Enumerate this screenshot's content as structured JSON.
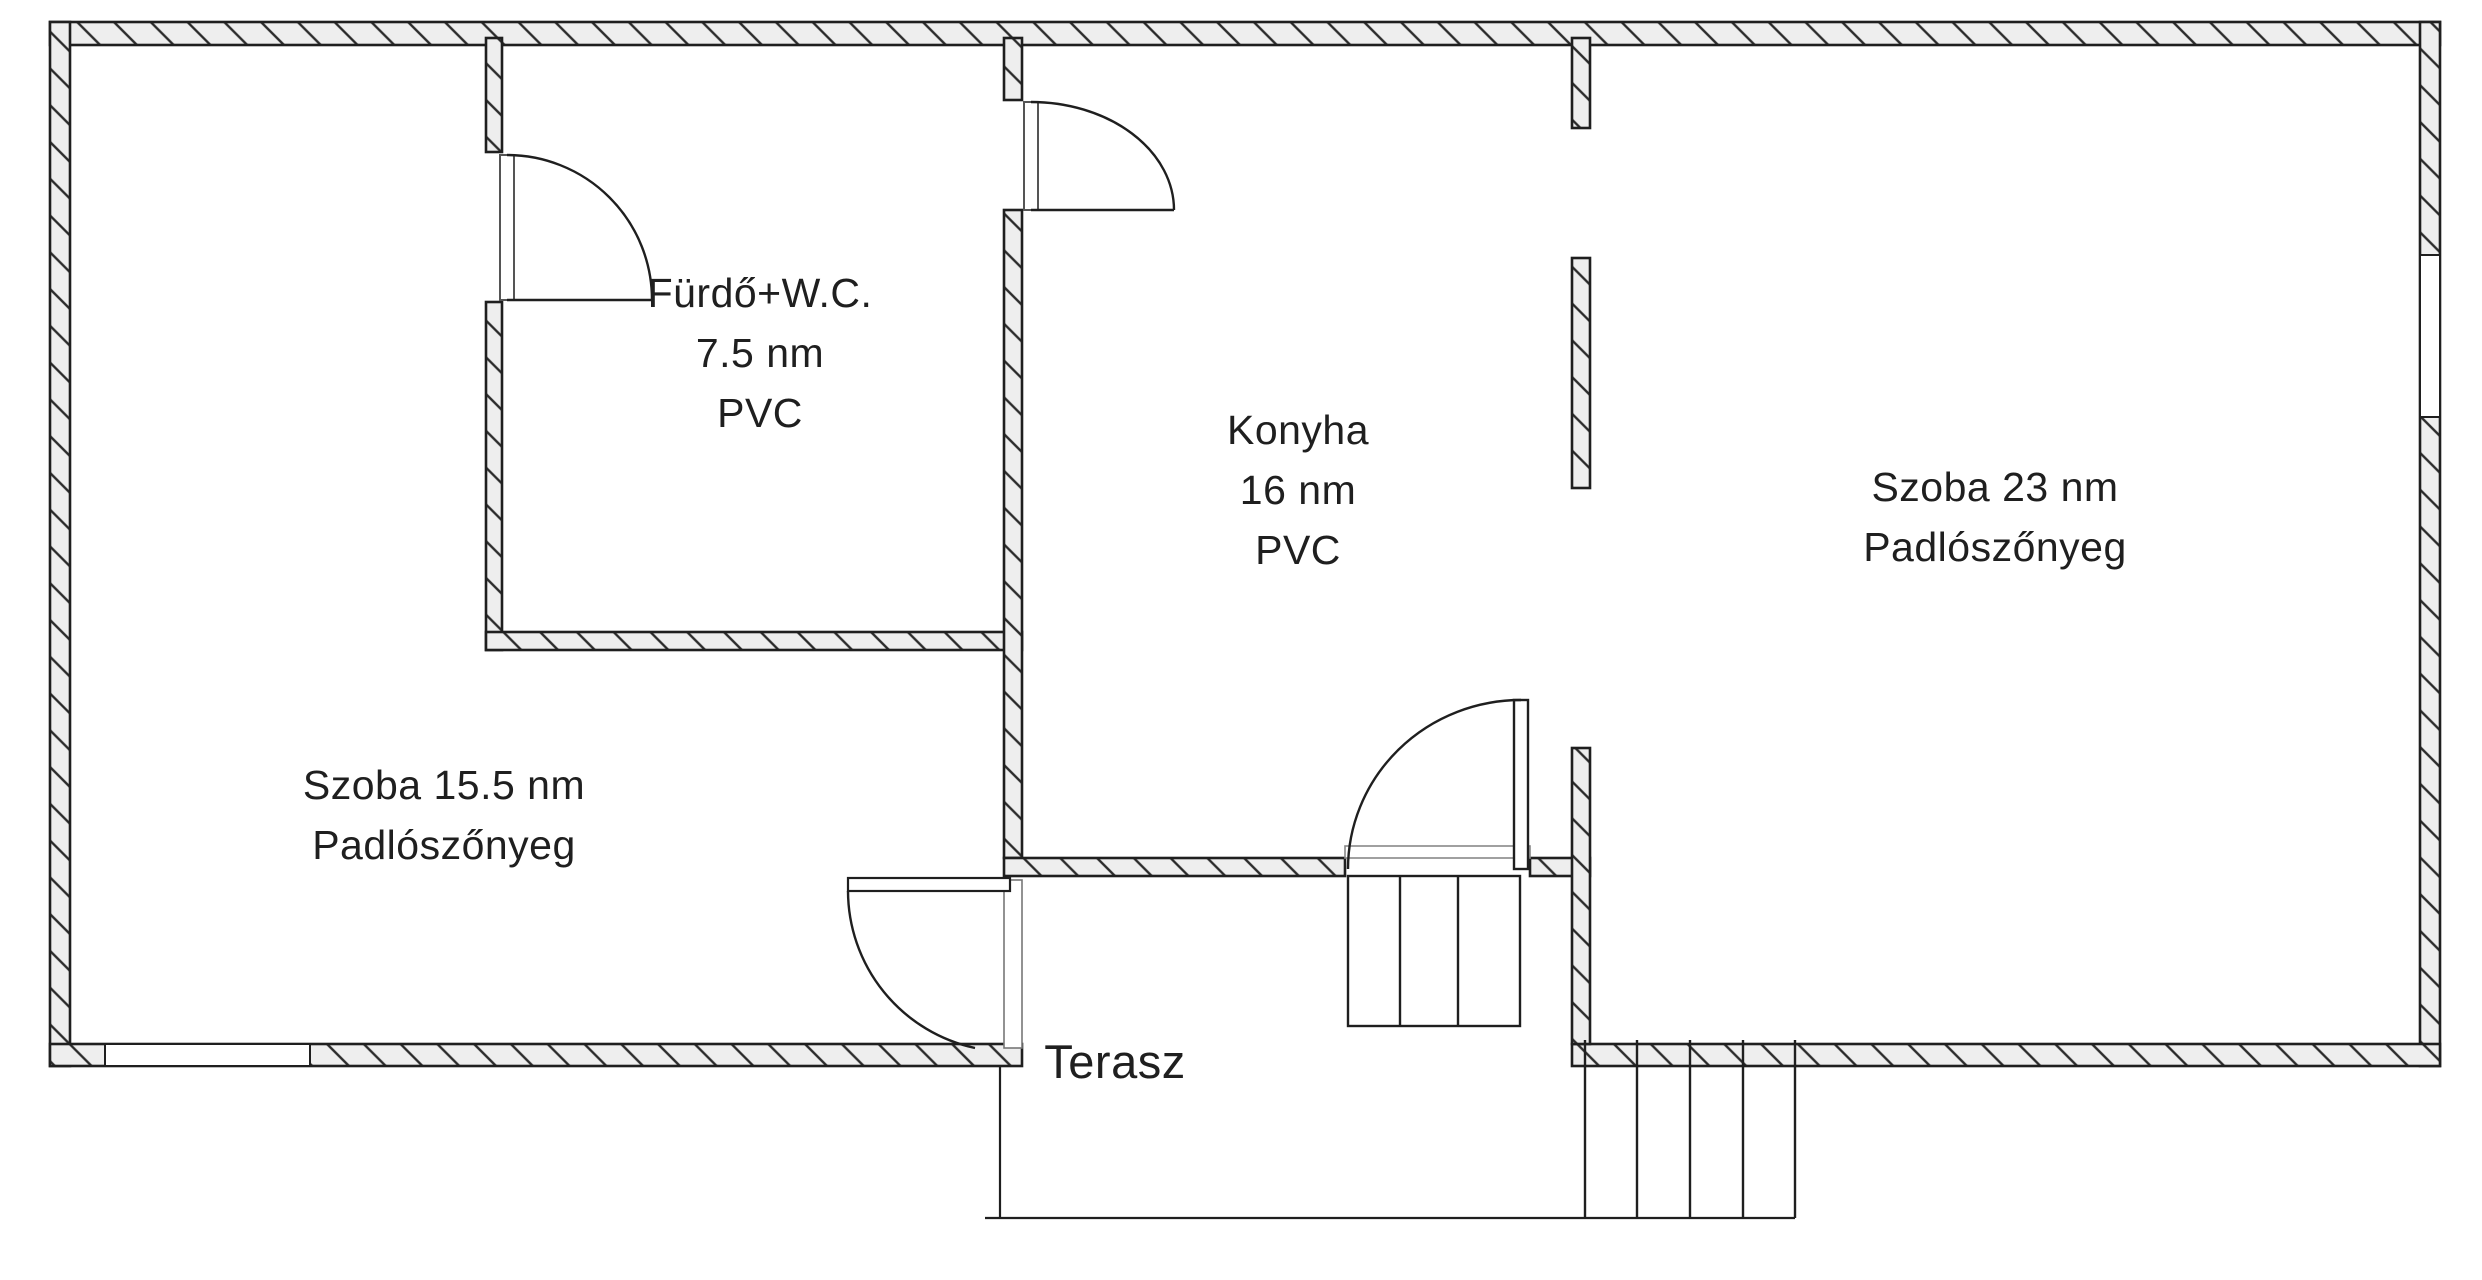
{
  "colors": {
    "line": "#1f1f1f",
    "wall_fill": "#eeeeee",
    "background": "#ffffff"
  },
  "rooms": [
    {
      "id": "szoba-15-5",
      "lines": [
        "Szoba 15.5 nm",
        "Padlószőnyeg"
      ]
    },
    {
      "id": "furdo-wc",
      "lines": [
        "Fürdő+W.C.",
        "7.5 nm",
        "PVC"
      ]
    },
    {
      "id": "konyha",
      "lines": [
        "Konyha",
        "16 nm",
        "PVC"
      ]
    },
    {
      "id": "szoba-23",
      "lines": [
        "Szoba 23 nm",
        "Padlószőnyeg"
      ]
    },
    {
      "id": "terasz",
      "lines": [
        "Terasz"
      ]
    }
  ]
}
